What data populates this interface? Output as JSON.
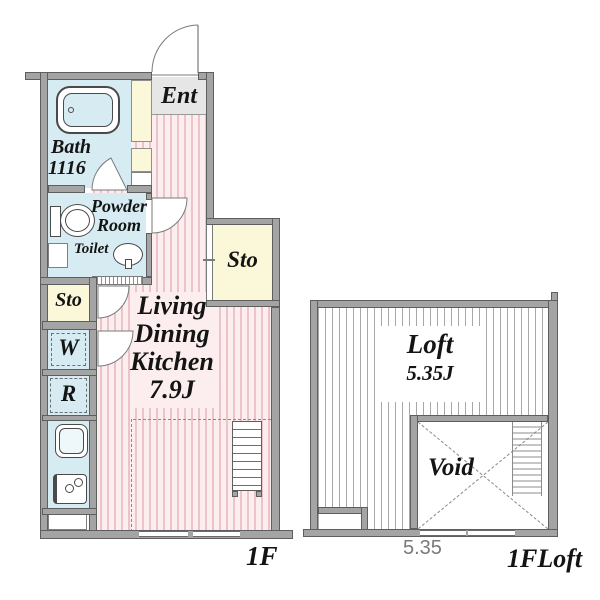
{
  "floor_1f": {
    "floor_label": "1F",
    "entrance_label": "Ent",
    "bath_label": "Bath",
    "bath_size": "1116",
    "powder_room_line1": "Powder",
    "powder_room_line2": "Room",
    "toilet_label": "Toilet",
    "storage_left_label": "Sto",
    "storage_right_label": "Sto",
    "washer_label": "W",
    "refrigerator_label": "R",
    "ldk_line1": "Living",
    "ldk_line2": "Dining",
    "ldk_line3": "Kitchen",
    "ldk_size": "7.9J"
  },
  "floor_loft": {
    "floor_label": "1FLoft",
    "loft_label": "Loft",
    "loft_size": "5.35J",
    "void_label": "Void",
    "width_dimension": "5.35"
  },
  "colors": {
    "wall": "#a4a4a4",
    "wet_area_blue": "#d7ecf2",
    "storage_yellow": "#faf8d8",
    "entrance_gray": "#e6e6e6",
    "ldk_pink_base": "#fceeee",
    "ldk_pink_stripe": "#ecc3c8",
    "loft_stripe_gray": "#a8a8a8",
    "dimension_text": "#7a7a7a"
  }
}
